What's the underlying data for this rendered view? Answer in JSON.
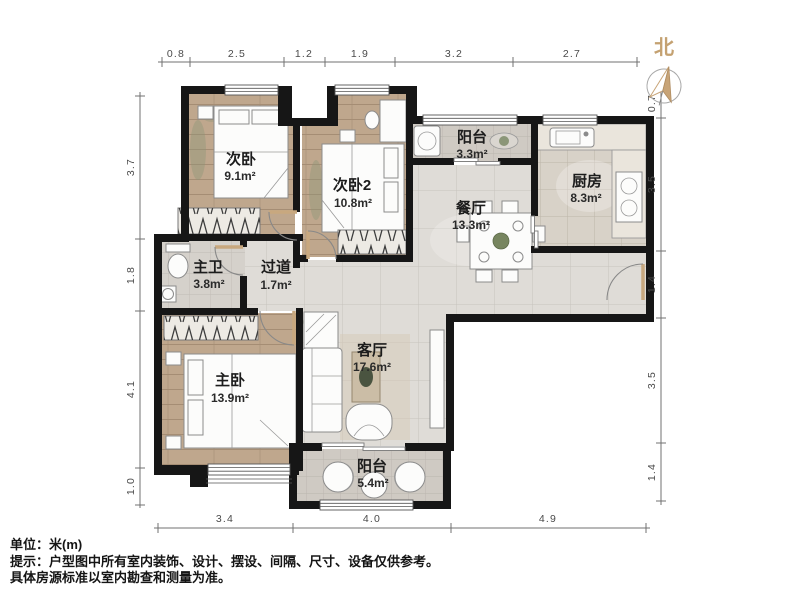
{
  "north": {
    "label": "北"
  },
  "rooms": [
    {
      "name": "次卧",
      "area": "9.1m²"
    },
    {
      "name": "次卧2",
      "area": "10.8m²"
    },
    {
      "name": "阳台",
      "area": "3.3m²"
    },
    {
      "name": "厨房",
      "area": "8.3m²"
    },
    {
      "name": "餐厅",
      "area": "13.3m²"
    },
    {
      "name": "主卫",
      "area": "3.8m²"
    },
    {
      "name": "过道",
      "area": "1.7m²"
    },
    {
      "name": "主卧",
      "area": "13.9m²"
    },
    {
      "name": "客厅",
      "area": "17.6m²"
    },
    {
      "name": "阳台",
      "area": "5.4m²"
    }
  ],
  "dims": {
    "top": [
      "0.8",
      "2.5",
      "1.2",
      "1.9",
      "3.2",
      "2.7"
    ],
    "left": [
      "3.7",
      "1.8",
      "4.1",
      "1.0"
    ],
    "right": [
      "0.7",
      "3.5",
      "1.4",
      "3.5",
      "1.4"
    ],
    "bottom": [
      "3.4",
      "4.0",
      "4.9"
    ]
  },
  "notes": {
    "unit": "单位：米(m)",
    "tip": "提示：户型图中所有室内装饰、设计、摆设、间隔、尺寸、设备仅供参考。",
    "tip2": "具体房源标准以室内勘查和测量为准。"
  },
  "colors": {
    "wall": "#161616",
    "wood": "#bfa78d",
    "tile_light": "#dfdcd7",
    "tile_balcony": "#cfcac3",
    "tile_kitchen": "#d8d2c8",
    "tile_bath": "#d5d1cb",
    "north_arrow": "#c8a477"
  }
}
